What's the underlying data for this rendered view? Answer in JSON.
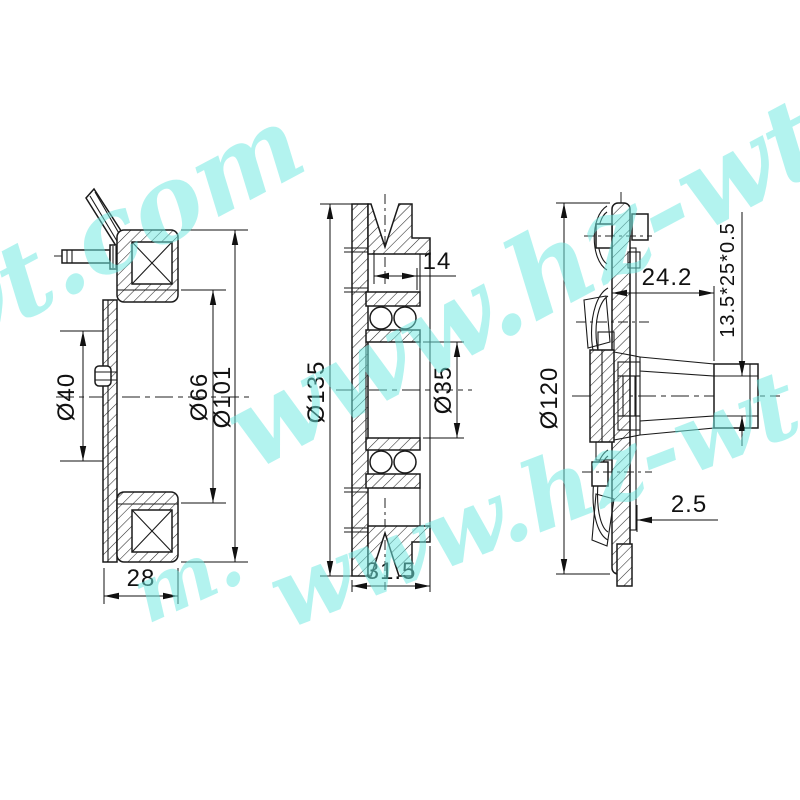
{
  "views": {
    "left": {
      "dim_bore": "Ø40",
      "dim_mid": "Ø66",
      "dim_outer": "Ø101",
      "dim_depth": "28"
    },
    "middle": {
      "dim_offset": "14",
      "dim_outer": "Ø135",
      "dim_bore": "Ø35",
      "dim_width": "31.5"
    },
    "right": {
      "dim_outer": "Ø120",
      "dim_depth": "24.2",
      "dim_spline": "13.5*25*0.5",
      "dim_gap": "2.5"
    }
  },
  "watermark": {
    "color": "#6ee9e1",
    "fragments": [
      {
        "text": "wt.com"
      },
      {
        "text": "www.hz-wt"
      },
      {
        "text": "www.hz-wt.c"
      },
      {
        "text": "m."
      }
    ]
  }
}
